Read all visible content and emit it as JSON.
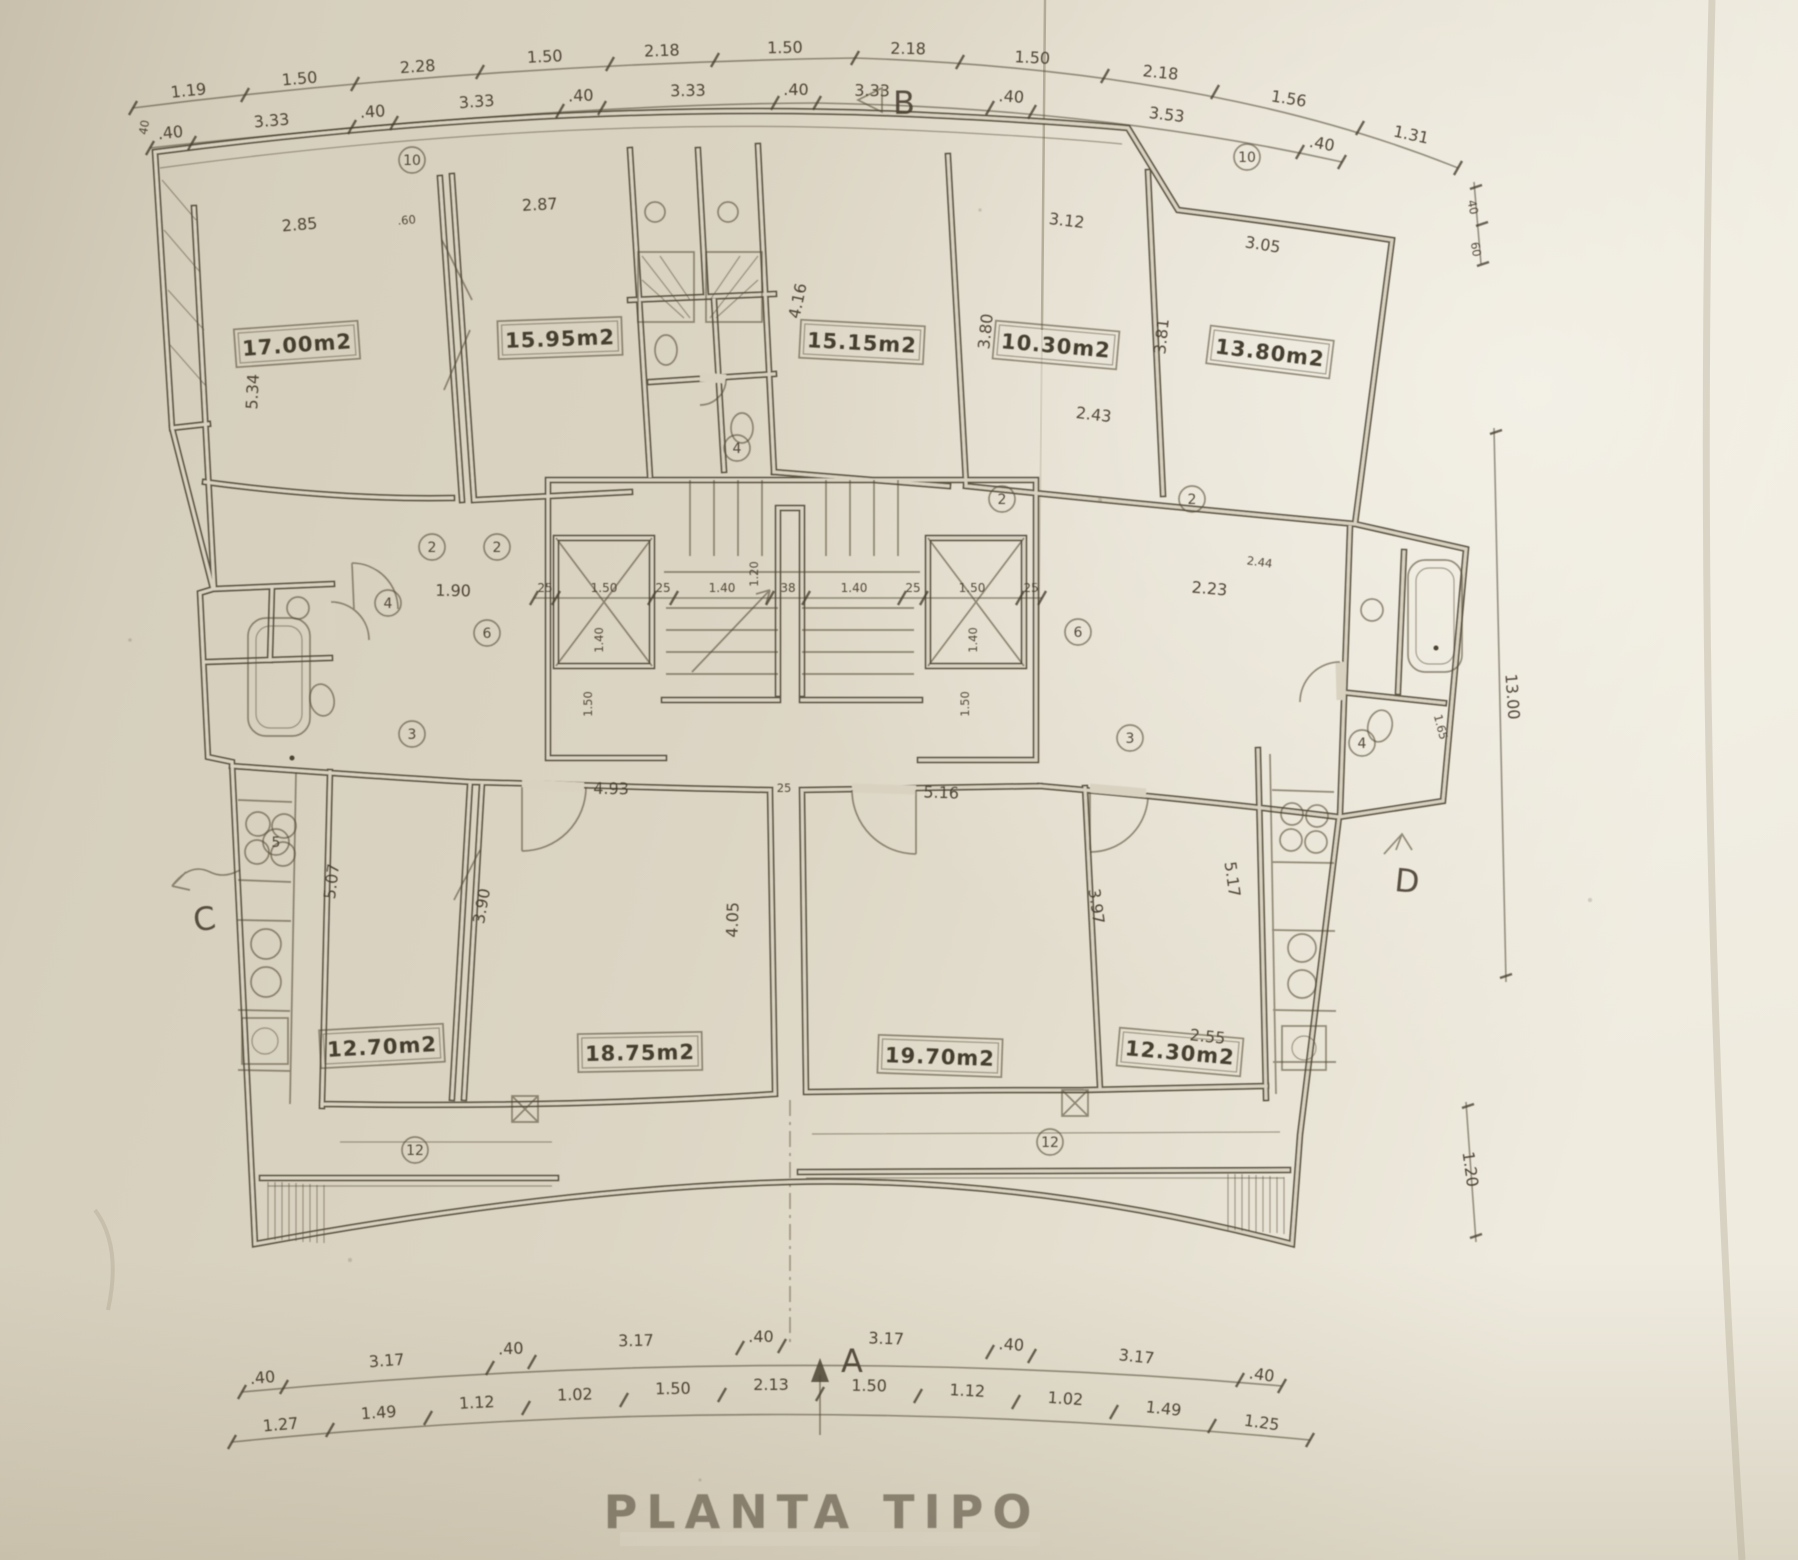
{
  "title": "PLANTA TIPO",
  "paper": {
    "background": "#d9d2c1",
    "line_color": "#4b4332",
    "shadow": "#b4aa94"
  },
  "rooms": {
    "top": [
      {
        "area": "17.00m2"
      },
      {
        "area": "15.95m2"
      },
      {
        "area": "15.15m2"
      },
      {
        "area": "10.30m2"
      },
      {
        "area": "13.80m2"
      }
    ],
    "bottom": [
      {
        "area": "12.70m2"
      },
      {
        "area": "18.75m2"
      },
      {
        "area": "19.70m2"
      },
      {
        "area": "12.30m2"
      }
    ]
  },
  "sections": {
    "top": "B",
    "bottom": "A",
    "left": "C",
    "right": "D"
  },
  "dims": {
    "top_outer": [
      "1.19",
      "1.50",
      "2.28",
      "1.50",
      "2.18",
      "1.50",
      "2.18",
      "1.50",
      "2.18",
      "1.56",
      "1.31"
    ],
    "top_inner": [
      ".40",
      "3.33",
      ".40",
      "3.33",
      ".40",
      "3.33",
      ".40",
      "3.33",
      ".40",
      "3.53",
      ".40"
    ],
    "bottom_inner": [
      ".40",
      "3.17",
      ".40",
      "3.17",
      ".40",
      "3.17",
      ".40",
      "3.17",
      ".40"
    ],
    "bottom_outer": [
      "1.27",
      "1.49",
      "1.12",
      "1.02",
      "1.50",
      "2.13",
      "1.50",
      "1.12",
      "1.02",
      "1.49",
      "1.25"
    ],
    "core": [
      "25",
      "1.50",
      "25",
      "1.40",
      "38",
      "1.40",
      "25",
      "1.50",
      "25"
    ],
    "interior": [
      "2.85",
      ".60",
      "2.87",
      "3.12",
      "3.05",
      "5.34",
      "4.16",
      "3.80",
      "3.81",
      "2.43",
      "1.90",
      "2.23",
      "2.44",
      "1.20",
      "1.40",
      "1.40",
      "1.50",
      "1.50",
      "4.93",
      "25",
      "5.16",
      "5.07",
      "3.90",
      "4.05",
      "3.97",
      "5.17",
      "2.55",
      "1.65",
      "13.00",
      "1.20",
      "40",
      "60",
      "40"
    ]
  },
  "markers": [
    "2",
    "2",
    "2",
    "2",
    "3",
    "3",
    "4",
    "4",
    "4",
    "5",
    "6",
    "6",
    "10",
    "10",
    "12",
    "12"
  ]
}
